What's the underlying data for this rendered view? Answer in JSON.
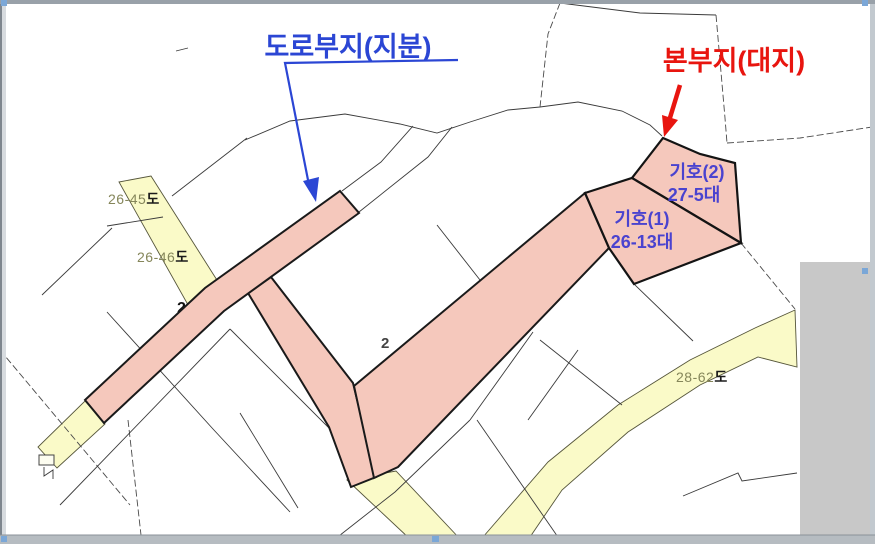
{
  "annotations": {
    "road_share_label": "도로부지(지분)",
    "main_parcel_label": "본부지(대지)"
  },
  "parcel_labels": {
    "giho2_name": "기호(2)",
    "giho2_lot": "27-5대",
    "giho1_name": "기호(1)",
    "giho1_lot": "26-13대"
  },
  "road_labels": {
    "r2645": {
      "num": "26-45",
      "suffix": "도"
    },
    "r2646": {
      "num": "26-46",
      "suffix": "도"
    },
    "r2862": {
      "num": "28-62",
      "suffix": "도"
    }
  },
  "partial_labels": {
    "a": "2",
    "b": "2",
    "c": "도"
  },
  "colors": {
    "parcel_pink": "#f5c8bc",
    "road_yellow": "#fafac8",
    "annotation_blue": "#2b46d4",
    "annotation_red": "#e8150f",
    "parcel_text_blue": "#4a43cf",
    "olive_label": "#85865a",
    "outline_black": "#1a1a1a",
    "frame_gray": "#b6bcc1",
    "handle_blue": "#7ba7d7"
  }
}
